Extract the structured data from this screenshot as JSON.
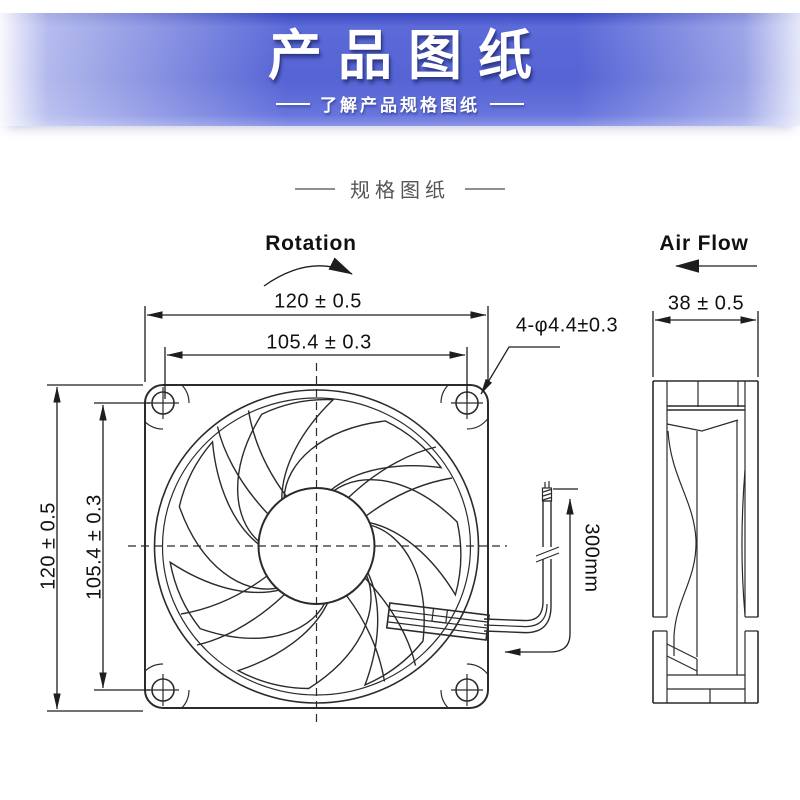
{
  "banner": {
    "title": "产品图纸",
    "subtitle": "了解产品规格图纸"
  },
  "section_header": {
    "title": "规格图纸"
  },
  "drawing": {
    "front": {
      "rotation_label": "Rotation",
      "dim_width": "120 ± 0.5",
      "dim_hole_pitch_horizontal": "105.4 ± 0.3",
      "dim_height": "120 ± 0.5",
      "dim_hole_pitch_vertical": "105.4 ± 0.3",
      "dim_mounting_holes": "4-φ4.4±0.3",
      "dim_wire_length": "300mm"
    },
    "side": {
      "airflow_label": "Air Flow",
      "dim_depth": "38 ± 0.5"
    }
  },
  "colors": {
    "banner_blue": "#5563d4",
    "banner_blue_dark": "#3a49c0",
    "line": "#2b2b2b",
    "text": "#111111",
    "muted_text": "#555555"
  }
}
